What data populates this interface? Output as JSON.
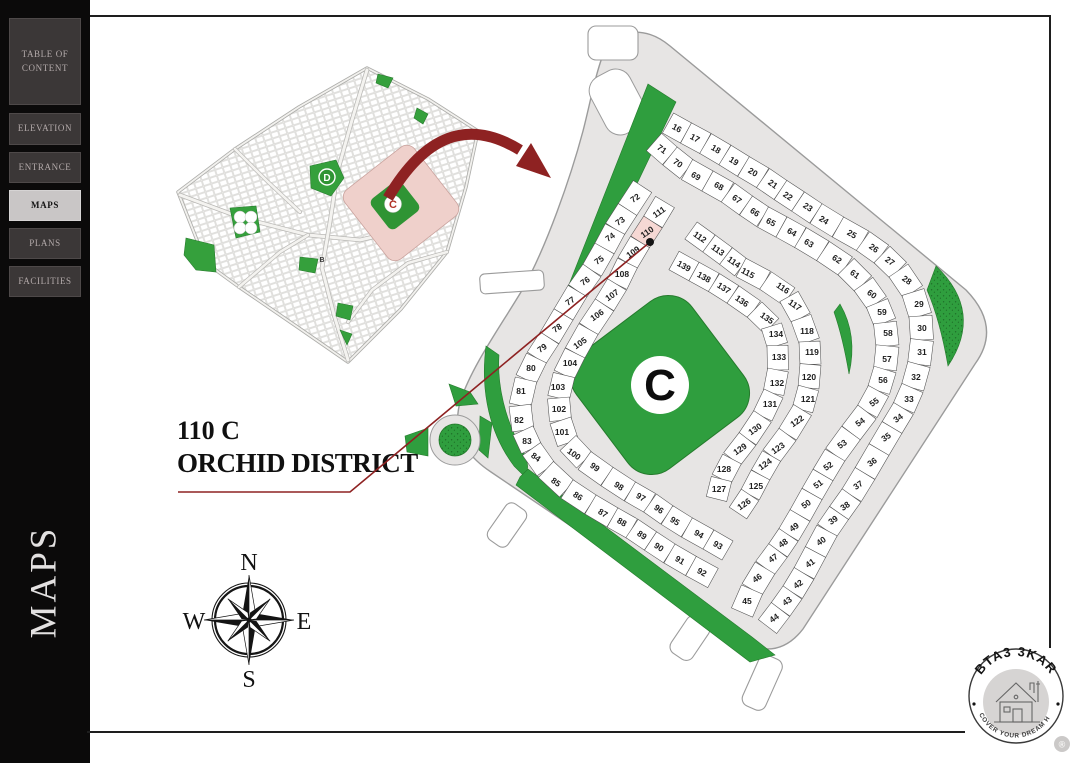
{
  "sidebar": {
    "items": [
      {
        "label": "TABLE OF CONTENT",
        "active": false
      },
      {
        "label": "ELEVATION",
        "active": false
      },
      {
        "label": "ENTRANCE",
        "active": false
      },
      {
        "label": "MAPS",
        "active": true
      },
      {
        "label": "PLANS",
        "active": false
      },
      {
        "label": "FACILITIES",
        "active": false
      }
    ],
    "vertical_label": "MAPS"
  },
  "callout": {
    "line1": "110 C",
    "line2": "ORCHID DISTRICT"
  },
  "compass": {
    "north": "N",
    "south": "S",
    "east": "E",
    "west": "W"
  },
  "logo": {
    "brand": "BTA3 3KAR",
    "tagline": "DISCOVER YOUR DREAM HOME",
    "registered": "®"
  },
  "overview_map": {
    "labels": {
      "district_d": "D",
      "district_c": "C",
      "district_b": "B"
    }
  },
  "detail_map": {
    "park_label": "C",
    "highlighted_plot": "110",
    "colors": {
      "green": "#2f9e3e",
      "road": "#e7e5e4",
      "plot_fill": "#ffffff",
      "plot_stroke": "#4f4f4f",
      "highlight": "#f6d8d4",
      "accent_red": "#8e2222"
    },
    "rows": [
      {
        "depth": 23,
        "plots": [
          {
            "n": 16,
            "x": 677,
            "y": 128
          },
          {
            "n": 17,
            "x": 695,
            "y": 138
          },
          {
            "n": 18,
            "x": 716,
            "y": 149
          },
          {
            "n": 19,
            "x": 734,
            "y": 161
          },
          {
            "n": 20,
            "x": 753,
            "y": 172
          },
          {
            "n": 21,
            "x": 773,
            "y": 184
          },
          {
            "n": 22,
            "x": 788,
            "y": 196
          },
          {
            "n": 23,
            "x": 808,
            "y": 207
          },
          {
            "n": 24,
            "x": 824,
            "y": 220
          },
          {
            "n": 25,
            "x": 852,
            "y": 234
          },
          {
            "n": 26,
            "x": 874,
            "y": 248
          },
          {
            "n": 27,
            "x": 890,
            "y": 261
          },
          {
            "n": 28,
            "x": 907,
            "y": 280
          },
          {
            "n": 29,
            "x": 919,
            "y": 304
          },
          {
            "n": 30,
            "x": 922,
            "y": 328
          },
          {
            "n": 31,
            "x": 922,
            "y": 352
          },
          {
            "n": 32,
            "x": 916,
            "y": 377
          },
          {
            "n": 33,
            "x": 909,
            "y": 399
          },
          {
            "n": 34,
            "x": 898,
            "y": 418
          },
          {
            "n": 35,
            "x": 886,
            "y": 437
          },
          {
            "n": 36,
            "x": 872,
            "y": 462
          },
          {
            "n": 37,
            "x": 858,
            "y": 485
          },
          {
            "n": 38,
            "x": 845,
            "y": 506
          },
          {
            "n": 39,
            "x": 833,
            "y": 520
          },
          {
            "n": 40,
            "x": 821,
            "y": 541
          },
          {
            "n": 41,
            "x": 810,
            "y": 563
          },
          {
            "n": 42,
            "x": 798,
            "y": 584
          },
          {
            "n": 43,
            "x": 787,
            "y": 601
          },
          {
            "n": 44,
            "x": 774,
            "y": 618
          }
        ]
      },
      {
        "depth": 23,
        "plots": [
          {
            "n": 71,
            "x": 662,
            "y": 149
          },
          {
            "n": 70,
            "x": 678,
            "y": 163
          },
          {
            "n": 69,
            "x": 696,
            "y": 176
          },
          {
            "n": 68,
            "x": 719,
            "y": 186
          },
          {
            "n": 67,
            "x": 737,
            "y": 199
          },
          {
            "n": 66,
            "x": 755,
            "y": 212
          },
          {
            "n": 65,
            "x": 771,
            "y": 222
          },
          {
            "n": 64,
            "x": 792,
            "y": 232
          },
          {
            "n": 63,
            "x": 809,
            "y": 243
          },
          {
            "n": 62,
            "x": 837,
            "y": 259
          },
          {
            "n": 61,
            "x": 855,
            "y": 274
          },
          {
            "n": 60,
            "x": 872,
            "y": 294
          },
          {
            "n": 59,
            "x": 882,
            "y": 312
          },
          {
            "n": 58,
            "x": 888,
            "y": 333
          },
          {
            "n": 57,
            "x": 887,
            "y": 359
          },
          {
            "n": 56,
            "x": 883,
            "y": 380
          },
          {
            "n": 55,
            "x": 874,
            "y": 402
          },
          {
            "n": 54,
            "x": 860,
            "y": 422
          },
          {
            "n": 53,
            "x": 842,
            "y": 444
          },
          {
            "n": 52,
            "x": 828,
            "y": 466
          },
          {
            "n": 51,
            "x": 818,
            "y": 484
          },
          {
            "n": 50,
            "x": 806,
            "y": 504
          },
          {
            "n": 49,
            "x": 794,
            "y": 527
          },
          {
            "n": 48,
            "x": 783,
            "y": 543
          },
          {
            "n": 47,
            "x": 773,
            "y": 558
          },
          {
            "n": 46,
            "x": 757,
            "y": 578
          },
          {
            "n": 45,
            "x": 747,
            "y": 601
          }
        ]
      },
      {
        "depth": 22,
        "plots": [
          {
            "n": 72,
            "x": 635,
            "y": 198
          },
          {
            "n": 73,
            "x": 620,
            "y": 221
          },
          {
            "n": 74,
            "x": 610,
            "y": 237
          },
          {
            "n": 75,
            "x": 599,
            "y": 260
          },
          {
            "n": 76,
            "x": 585,
            "y": 281
          },
          {
            "n": 77,
            "x": 570,
            "y": 301
          },
          {
            "n": 78,
            "x": 557,
            "y": 328
          },
          {
            "n": 79,
            "x": 542,
            "y": 348
          },
          {
            "n": 80,
            "x": 531,
            "y": 368
          },
          {
            "n": 81,
            "x": 521,
            "y": 391
          },
          {
            "n": 82,
            "x": 519,
            "y": 420
          },
          {
            "n": 83,
            "x": 527,
            "y": 441
          },
          {
            "n": 84,
            "x": 536,
            "y": 457
          },
          {
            "n": 85,
            "x": 556,
            "y": 482
          },
          {
            "n": 86,
            "x": 578,
            "y": 496
          },
          {
            "n": 87,
            "x": 603,
            "y": 513
          },
          {
            "n": 88,
            "x": 622,
            "y": 522
          },
          {
            "n": 89,
            "x": 642,
            "y": 535
          },
          {
            "n": 90,
            "x": 659,
            "y": 547
          },
          {
            "n": 91,
            "x": 680,
            "y": 560
          },
          {
            "n": 92,
            "x": 702,
            "y": 572
          }
        ]
      },
      {
        "depth": 22,
        "plots": [
          {
            "n": 111,
            "x": 659,
            "y": 212
          },
          {
            "n": 110,
            "x": 647,
            "y": 232,
            "h": true
          },
          {
            "n": 109,
            "x": 633,
            "y": 252
          },
          {
            "n": 108,
            "x": 622,
            "y": 274
          },
          {
            "n": 107,
            "x": 612,
            "y": 295
          },
          {
            "n": 106,
            "x": 597,
            "y": 315
          },
          {
            "n": 105,
            "x": 580,
            "y": 343
          },
          {
            "n": 104,
            "x": 570,
            "y": 363
          },
          {
            "n": 103,
            "x": 558,
            "y": 387
          },
          {
            "n": 102,
            "x": 559,
            "y": 409
          },
          {
            "n": 101,
            "x": 562,
            "y": 432
          },
          {
            "n": 100,
            "x": 574,
            "y": 454
          },
          {
            "n": 99,
            "x": 595,
            "y": 467
          },
          {
            "n": 98,
            "x": 619,
            "y": 486
          },
          {
            "n": 97,
            "x": 641,
            "y": 497
          },
          {
            "n": 96,
            "x": 659,
            "y": 509
          },
          {
            "n": 95,
            "x": 675,
            "y": 521
          },
          {
            "n": 94,
            "x": 699,
            "y": 534
          },
          {
            "n": 93,
            "x": 718,
            "y": 545
          }
        ]
      },
      {
        "depth": 21,
        "plots": [
          {
            "n": 112,
            "x": 700,
            "y": 237
          },
          {
            "n": 113,
            "x": 718,
            "y": 250
          },
          {
            "n": 114,
            "x": 734,
            "y": 262
          },
          {
            "n": 115,
            "x": 748,
            "y": 273
          },
          {
            "n": 116,
            "x": 783,
            "y": 288
          },
          {
            "n": 117,
            "x": 795,
            "y": 305
          },
          {
            "n": 118,
            "x": 807,
            "y": 331
          },
          {
            "n": 119,
            "x": 812,
            "y": 352
          },
          {
            "n": 120,
            "x": 809,
            "y": 377
          },
          {
            "n": 121,
            "x": 808,
            "y": 399
          },
          {
            "n": 122,
            "x": 797,
            "y": 421
          },
          {
            "n": 123,
            "x": 778,
            "y": 448
          },
          {
            "n": 124,
            "x": 765,
            "y": 464
          },
          {
            "n": 125,
            "x": 756,
            "y": 486
          },
          {
            "n": 126,
            "x": 744,
            "y": 504
          }
        ]
      },
      {
        "depth": 21,
        "plots": [
          {
            "n": 139,
            "x": 684,
            "y": 266
          },
          {
            "n": 138,
            "x": 704,
            "y": 277
          },
          {
            "n": 137,
            "x": 724,
            "y": 288
          },
          {
            "n": 136,
            "x": 742,
            "y": 301
          },
          {
            "n": 135,
            "x": 767,
            "y": 318
          },
          {
            "n": 134,
            "x": 776,
            "y": 334
          },
          {
            "n": 133,
            "x": 779,
            "y": 357
          },
          {
            "n": 132,
            "x": 777,
            "y": 383
          },
          {
            "n": 131,
            "x": 770,
            "y": 404
          },
          {
            "n": 130,
            "x": 755,
            "y": 429
          },
          {
            "n": 129,
            "x": 740,
            "y": 449
          },
          {
            "n": 128,
            "x": 724,
            "y": 469
          },
          {
            "n": 127,
            "x": 719,
            "y": 489
          }
        ]
      }
    ]
  }
}
